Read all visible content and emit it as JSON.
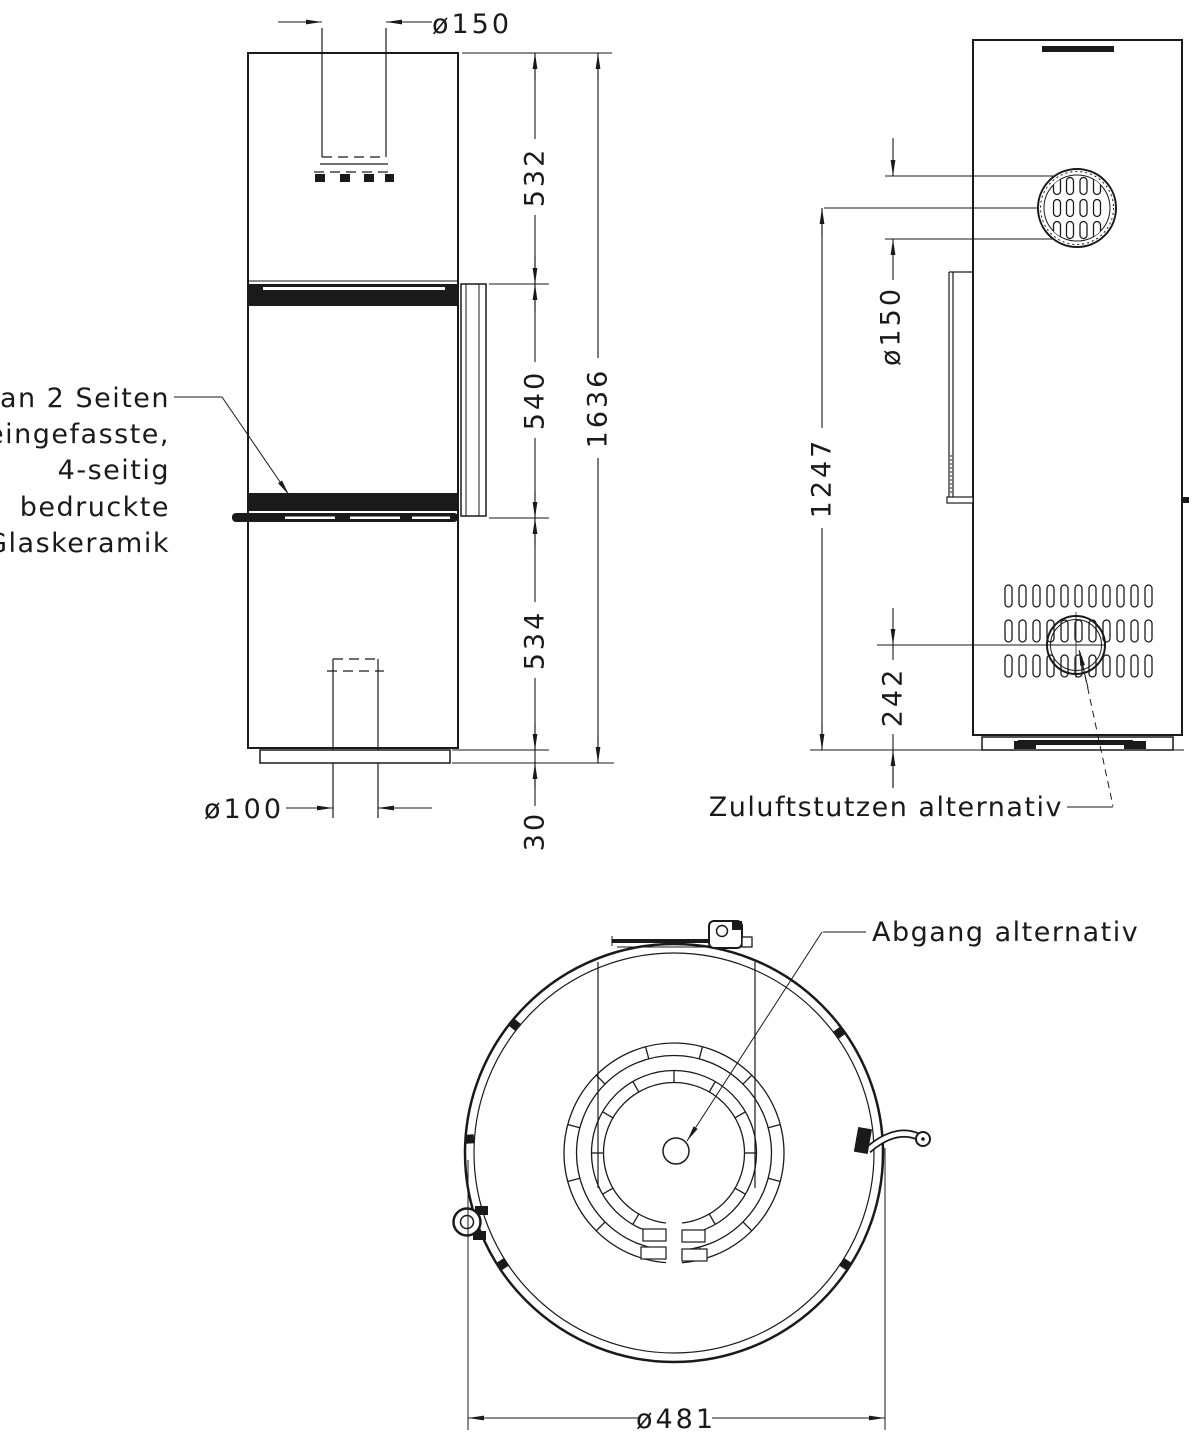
{
  "drawing": {
    "kind": "technical dimension drawing",
    "colors": {
      "line": "#1a1a1a",
      "background": "#ffffff"
    }
  },
  "views": {
    "front": {
      "note": {
        "lines": [
          "an 2 Seiten",
          "eingefasste,",
          "4-seitig",
          "bedruckte",
          "Glaskeramik"
        ]
      },
      "dims": {
        "flue_diameter": "ø150",
        "upper_height": "532",
        "window_height": "540",
        "lower_height": "534",
        "plinth_height": "30",
        "total_height": "1636",
        "air_inlet_diameter": "ø100"
      }
    },
    "side": {
      "label": "Zuluftstutzen alternativ",
      "dims": {
        "rear_flue_diameter": "ø150",
        "flue_axis_height": "1247",
        "inlet_axis_height": "242"
      }
    },
    "top": {
      "label": "Abgang alternativ",
      "dims": {
        "diameter": "ø481"
      }
    }
  }
}
